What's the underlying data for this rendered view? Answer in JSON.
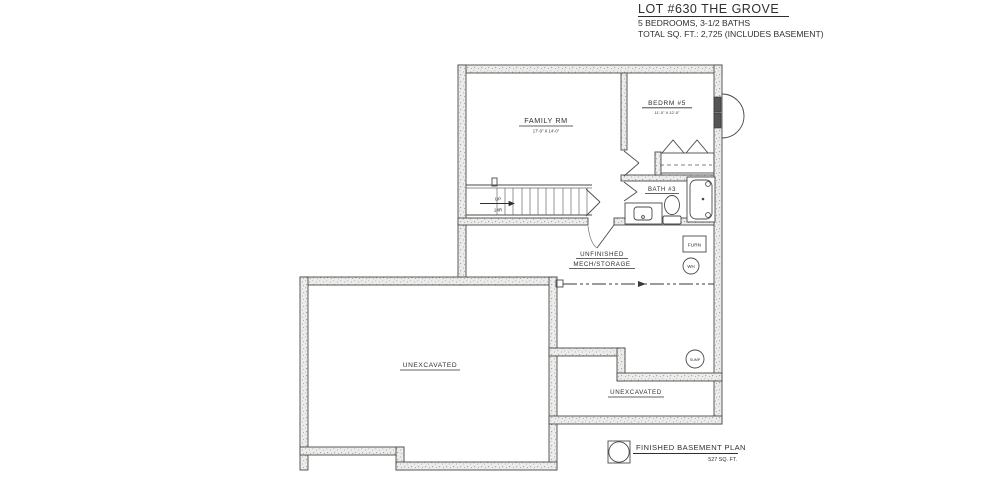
{
  "title_block": {
    "lot_title": "LOT #630 THE GROVE",
    "specs_line": "5 BEDROOMS, 3-1/2 BATHS",
    "total_line": "TOTAL SQ. FT.: 2,725 (INCLUDES BASEMENT)"
  },
  "plan_caption": {
    "name": "FINISHED BASEMENT PLAN",
    "area": "527 SQ. FT."
  },
  "rooms": {
    "family": {
      "name": "FAMILY RM",
      "dims": "17'-0\" X 14'-0\""
    },
    "bedroom5": {
      "name": "BEDRM #5",
      "dims": "11'-0\" X 12'-0\""
    },
    "bath3": {
      "name": "BATH #3"
    },
    "mech_line1": "UNFINISHED",
    "mech_line2": "MECH/STORAGE",
    "unexcavated_main": "UNEXCAVATED",
    "unexcavated_small": "UNEXCAVATED"
  },
  "equipment": {
    "furnace": "FURN",
    "water_heater": "WH",
    "sump_pump": "SUMP"
  },
  "stairs": {
    "direction": "UP",
    "risers": "14R"
  },
  "colors": {
    "line": "#4a4a4a",
    "wall_fill": "#ececea",
    "speckle": "#a0a09a",
    "background": "#ffffff"
  }
}
